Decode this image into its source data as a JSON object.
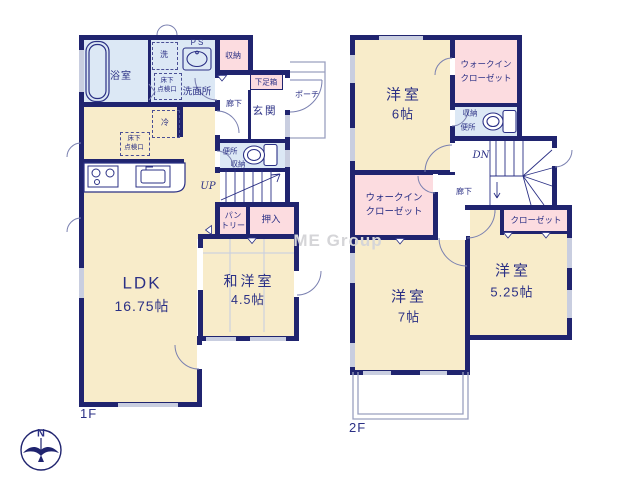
{
  "watermark": "ME Group",
  "compass": {
    "north": "N"
  },
  "colors": {
    "wall": "#20246f",
    "room_cream": "#f8ecca",
    "closet_pink": "#fcdce0",
    "wet_blue": "#dce8f5",
    "window_gray": "#c9cee0",
    "text_navy": "#2b3085"
  },
  "f1": {
    "label": "1F",
    "bath": "浴室",
    "laundry": "洗",
    "ps": "PS",
    "washroom": "洗面所",
    "underfloor_line1": "床下",
    "underfloor_line2": "点検口",
    "storage": "収納",
    "hall": "廊下",
    "shoe_box": "下足箱",
    "entrance": "玄関",
    "porch": "ポーチ",
    "fridge": "冷",
    "toilet": "便所",
    "toilet_storage": "収納",
    "stairs_up": "UP",
    "pantry_line1": "パン",
    "pantry_line2": "トリー",
    "closet_oshiire": "押入",
    "ldk_name": "LDK",
    "ldk_size": "16.75帖",
    "tatami_name": "和洋室",
    "tatami_size": "4.5帖"
  },
  "f2": {
    "label": "2F",
    "room6_name": "洋室",
    "room6_size": "6帖",
    "wic_line1": "ウォークイン",
    "wic_line2": "クローゼット",
    "storage": "収納",
    "toilet": "便所",
    "stairs_down": "DN",
    "hall": "廊下",
    "closet": "クローゼット",
    "room525_name": "洋室",
    "room525_size": "5.25帖",
    "room7_name": "洋室",
    "room7_size": "7帖"
  }
}
